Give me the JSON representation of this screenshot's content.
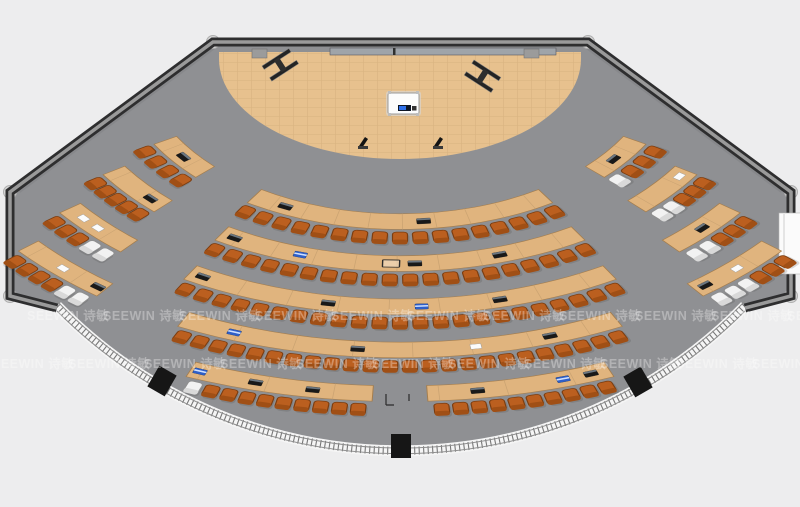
{
  "plan_title": "fan-shaped lecture hall floor plan",
  "watermark": {
    "text": "SEEWIN 诗敏",
    "rows": [
      {
        "y": 320,
        "x0": 27,
        "spacing": 76,
        "count": 11
      },
      {
        "y": 368,
        "x0": -8,
        "spacing": 76,
        "count": 11
      }
    ]
  },
  "palette": {
    "outside": "#ededee",
    "floor": "#8f9093",
    "wall_dark": "#2e2e2f",
    "wall_core": "#9a9a9a",
    "glass_band": "#f5f5f5",
    "glass_tick": "#4c4c4c",
    "glass_rail": "#8e8e8e",
    "stage": "#e7c18e",
    "stage_line": "#c9a26c",
    "desk": "#e0b47e",
    "desk_edge": "#a57e4e",
    "desk_seam": "#c6a070",
    "chair": "#bb5f1f",
    "chair_dark": "#7c3d10",
    "chair_back": "#a04f15",
    "chair_white": "#f2f2f2",
    "chair_white_edge": "#8f8f8f",
    "chair_white_back": "#d9d9d9",
    "column": "#d6d6d6",
    "column_edge": "#aeaeae",
    "door_block": "#161616",
    "item_dark": "#191919",
    "item_dark_strip": "#6b7680",
    "item_blue": "#2e5fc9",
    "item_paper": "#fbfbfb",
    "screen_strip": "#9fa4a9",
    "podium": "#fcfcfc",
    "podium_screen": "#0d1524",
    "podium_blue": "#2e6fe8"
  },
  "room": {
    "floor_path": "M213,42 L588,42 L791,192 L791,296 L745,308 A483,483 0 0 1 57,308 L10,296 L10,192 Z",
    "wall_path": "M57,308 L10,296 L10,192 L213,42 L588,42 L791,192 L791,296 L745,308",
    "glass_path": "M745,306 A481,481 0 0 1 57,306",
    "columns": [
      [
        213,
        42
      ],
      [
        588,
        42
      ],
      [
        791,
        192
      ],
      [
        791,
        296
      ],
      [
        10,
        296
      ],
      [
        10,
        192
      ]
    ],
    "door_blocks": [
      {
        "x": 162,
        "y": 381,
        "rot": 30
      },
      {
        "x": 401,
        "y": 446,
        "rot": 0
      },
      {
        "x": 638,
        "y": 382,
        "rot": -30
      }
    ],
    "right_door": {
      "x": 779,
      "y": 213,
      "w": 22,
      "h": 61
    },
    "floor_brackets": "M386,394 v11 M386,405 h8 M409,394 v7"
  },
  "stage": {
    "arc": {
      "cx": 400,
      "cy": 59,
      "rx": 181,
      "ry": 100,
      "top": 52
    },
    "podium": {
      "x": 388,
      "y": 93,
      "w": 31,
      "h": 21
    },
    "stands": [
      [
        357,
        136
      ],
      [
        432,
        136
      ]
    ],
    "beams": [
      {
        "x": 262,
        "y": 66,
        "rot": -33
      },
      {
        "x": 474,
        "y": 60,
        "rot": 33
      }
    ],
    "wall_screen": {
      "x": 330,
      "y": 48,
      "w": 226,
      "h": 7
    },
    "wall_tabs": [
      [
        252,
        49
      ],
      [
        524,
        49
      ]
    ],
    "wall_tick": [
      393,
      48
    ]
  },
  "seating": {
    "cx": 400,
    "cy": 59,
    "squash": 0.6,
    "desk_width": 26,
    "chair_offset": 40,
    "item_offset": 13,
    "chair_inset_deg": 1.3,
    "rings": [
      {
        "r": 258,
        "segments": [
          {
            "name": "wing-left",
            "a0": 46,
            "a1": 60,
            "chairs": 4,
            "white": [],
            "items": [
              {
                "a": 53,
                "t": "dark"
              }
            ]
          },
          {
            "name": "center",
            "a0": -32.5,
            "a1": 32.5,
            "chairs": 17,
            "white": [],
            "items": [
              {
                "a": 25,
                "t": "dark"
              },
              {
                "a": -5,
                "t": "dark"
              }
            ]
          },
          {
            "name": "wing-right",
            "a0": -60,
            "a1": -46,
            "chairs": 4,
            "white": [
              3
            ],
            "items": [
              {
                "a": -52,
                "t": "dark"
              }
            ]
          }
        ]
      },
      {
        "r": 328,
        "segments": [
          {
            "name": "wing-left",
            "a0": 44,
            "a1": 57,
            "chairs": 5,
            "white": [],
            "items": [
              {
                "a": 47,
                "t": "dark"
              }
            ]
          },
          {
            "name": "center",
            "a0": -31.5,
            "a1": 31.5,
            "chairs": 20,
            "white": [],
            "items": [
              {
                "a": 29,
                "t": "dark"
              },
              {
                "a": 17,
                "t": "blue"
              },
              {
                "a": 1.5,
                "t": "proj"
              },
              {
                "a": -2.5,
                "t": "dark"
              },
              {
                "a": -17,
                "t": "dark"
              }
            ]
          },
          {
            "name": "wing-right",
            "a0": -57,
            "a1": -44,
            "chairs": 5,
            "white": [
              3,
              4
            ],
            "items": [
              {
                "a": -55,
                "t": "paper"
              }
            ]
          }
        ]
      },
      {
        "r": 400,
        "segments": [
          {
            "name": "wing-left",
            "a0": 41,
            "a1": 53,
            "chairs": 5,
            "white": [
              0,
              1
            ],
            "items": [
              {
                "a": 50,
                "t": "paper"
              },
              {
                "a": 47,
                "t": "paper"
              }
            ]
          },
          {
            "name": "center",
            "a0": -30.5,
            "a1": 30.5,
            "chairs": 23,
            "white": [],
            "items": [
              {
                "a": 28.5,
                "t": "dark"
              },
              {
                "a": 10,
                "t": "dark"
              },
              {
                "a": -3,
                "t": "blue"
              },
              {
                "a": -14,
                "t": "dark"
              }
            ]
          },
          {
            "name": "wing-right",
            "a0": -53,
            "a1": -41,
            "chairs": 5,
            "white": [
              3,
              4
            ],
            "items": [
              {
                "a": -47,
                "t": "dark"
              }
            ]
          }
        ]
      },
      {
        "r": 472,
        "segments": [
          {
            "name": "wing-left",
            "a0": 37.5,
            "a1": 50,
            "chairs": 6,
            "white": [
              0,
              1
            ],
            "items": [
              {
                "a": 44,
                "t": "paper"
              },
              {
                "a": 38.5,
                "t": "dark"
              }
            ]
          },
          {
            "name": "center",
            "a0": -26.5,
            "a1": 26.5,
            "chairs": 24,
            "white": [],
            "items": [
              {
                "a": 20,
                "t": "blue"
              },
              {
                "a": 5,
                "t": "dark"
              },
              {
                "a": -9,
                "t": "paper"
              },
              {
                "a": -18,
                "t": "dark"
              }
            ]
          },
          {
            "name": "wing-right",
            "a0": -50,
            "a1": -37.5,
            "chairs": 6,
            "white": [
              3,
              4,
              5
            ],
            "items": [
              {
                "a": -44,
                "t": "paper"
              },
              {
                "a": -39,
                "t": "dark"
              }
            ]
          }
        ]
      },
      {
        "r": 545,
        "segments": [
          {
            "name": "back-left",
            "a0": 2.8,
            "a1": 22,
            "chairs": 10,
            "white": [
              9
            ],
            "items": [
              {
                "a": 21,
                "t": "blue"
              },
              {
                "a": 15,
                "t": "dark"
              },
              {
                "a": 9,
                "t": "dark"
              }
            ]
          },
          {
            "name": "back-right",
            "a0": -22,
            "a1": -2.8,
            "chairs": 10,
            "white": [],
            "items": [
              {
                "a": -8,
                "t": "dark"
              },
              {
                "a": -17,
                "t": "blue"
              },
              {
                "a": -20,
                "t": "dark"
              }
            ]
          }
        ]
      }
    ]
  }
}
